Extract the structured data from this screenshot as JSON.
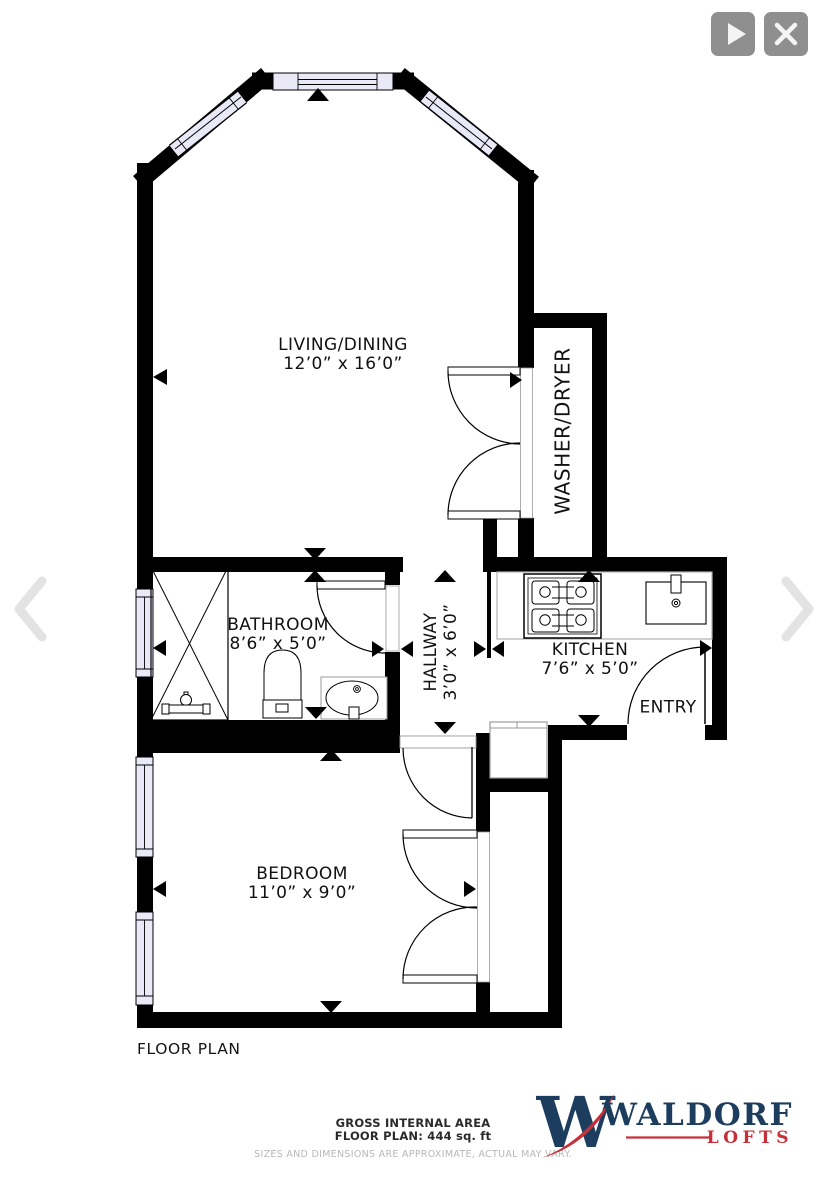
{
  "toolbar": {
    "play_icon": "play",
    "close_icon": "close"
  },
  "navigation": {
    "prev_icon": "chevron-left",
    "next_icon": "chevron-right"
  },
  "plan": {
    "title": "FLOOR PLAN",
    "rooms": {
      "living": {
        "name": "LIVING/DINING",
        "dims": "12’0” x 16’0”"
      },
      "washer": {
        "name": "WASHER/DRYER"
      },
      "bathroom": {
        "name": "BATHROOM",
        "dims": "8’6” x 5’0”"
      },
      "hallway": {
        "name": "HALLWAY",
        "dims": "3’0” x 6’0”"
      },
      "kitchen": {
        "name": "KITCHEN",
        "dims": "7’6” x 5’0”"
      },
      "entry": {
        "name": "ENTRY"
      },
      "bedroom": {
        "name": "BEDROOM",
        "dims": "11’0” x 9’0”"
      }
    }
  },
  "footer": {
    "area_title": "GROSS INTERNAL AREA",
    "area_value": "FLOOR PLAN: 444 sq. ft",
    "disclaimer": "SIZES AND DIMENSIONS ARE APPROXIMATE, ACTUAL MAY VARY."
  },
  "brand": {
    "monogram": "W",
    "name": "WALDORF",
    "suffix": "LOFTS",
    "navy": "#1c3d5e",
    "red": "#c5303a"
  }
}
